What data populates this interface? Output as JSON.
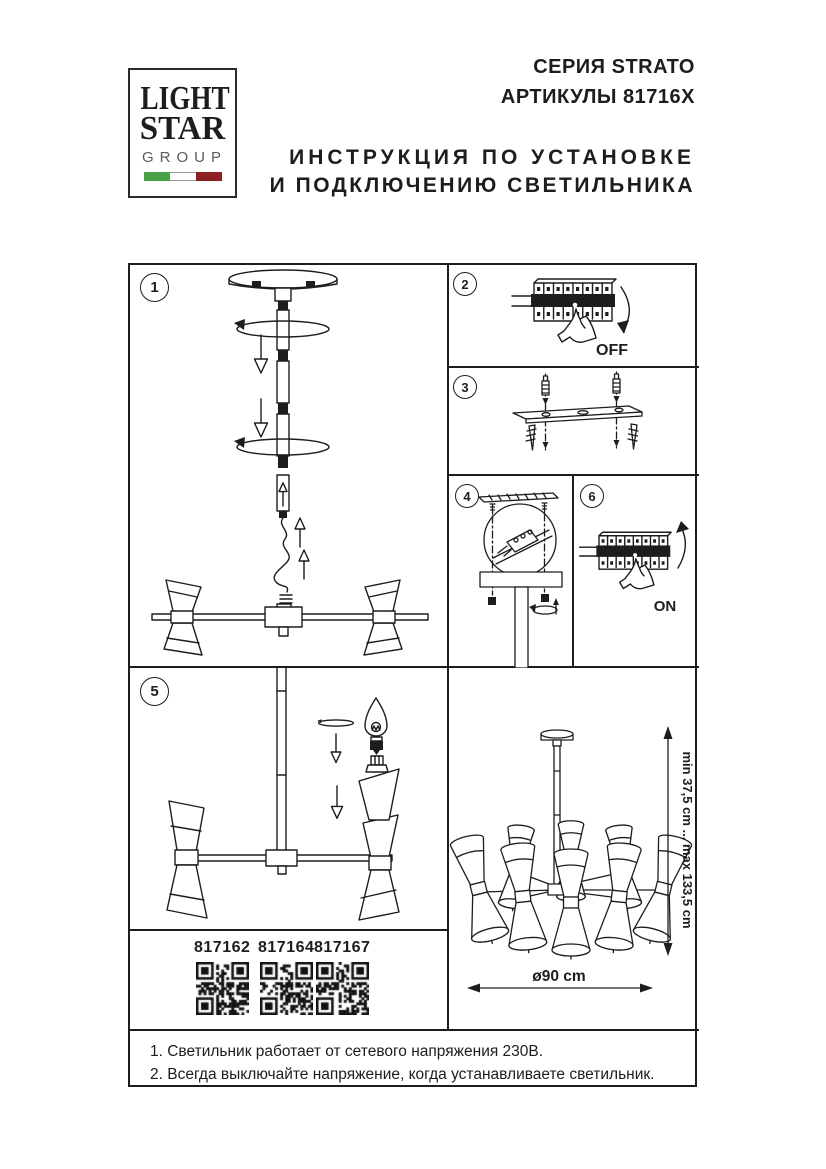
{
  "page": {
    "background": "#ffffff",
    "line_color": "#1d1d1b"
  },
  "logo": {
    "line1": "LIGHT",
    "line2": "STAR",
    "line3": "GROUP",
    "flag_colors": [
      "#4aa147",
      "#ffffff",
      "#8e2023"
    ]
  },
  "header": {
    "series": "СЕРИЯ STRATO",
    "articles": "АРТИКУЛЫ 81716X",
    "instruction_line1": "ИНСТРУКЦИЯ ПО УСТАНОВКЕ",
    "instruction_line2": "И ПОДКЛЮЧЕНИЮ СВЕТИЛЬНИКА"
  },
  "steps": [
    "1",
    "2",
    "3",
    "4",
    "5",
    "6"
  ],
  "labels": {
    "breaker_off": "OFF",
    "breaker_on": "ON",
    "height_range": "min 37,5 cm ... max 133,5 cm",
    "diameter": "ø90 cm"
  },
  "qr_codes": [
    {
      "label": "817162"
    },
    {
      "label": "817164"
    },
    {
      "label": "817167"
    }
  ],
  "notes": [
    "1. Светильник работает от сетевого напряжения 230В.",
    "2. Всегда выключайте напряжение, когда устанавливаете светильник."
  ]
}
